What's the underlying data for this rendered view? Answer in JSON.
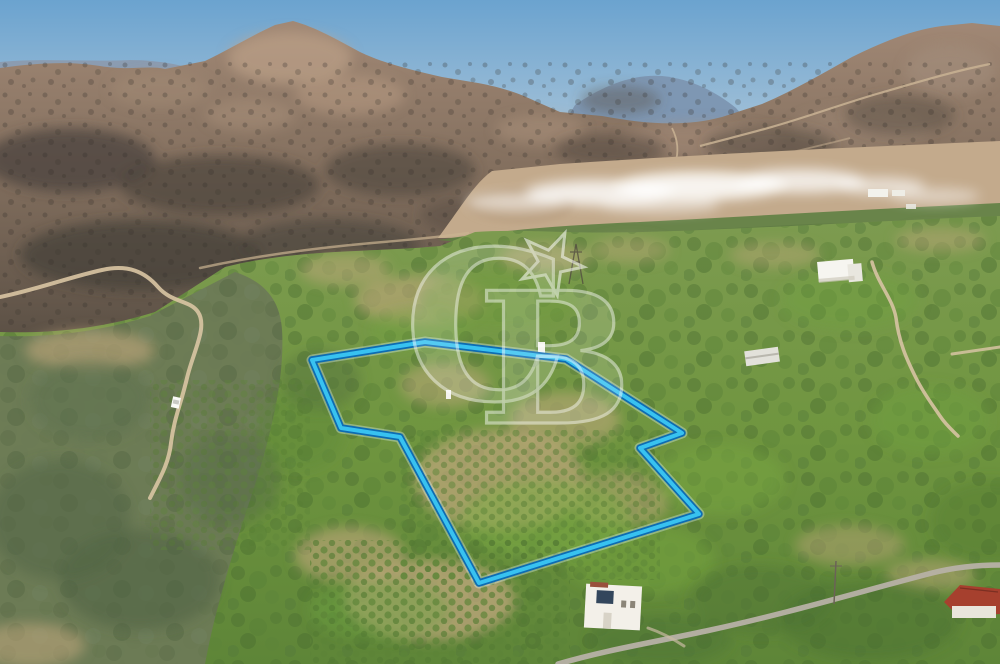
{
  "image": {
    "alt": "Aerial drone photo of a land parcel outlined in blue among green orchards, with burnt mountain slopes and a white smoke plume in the background"
  },
  "watermark": {
    "letter_c": "C",
    "letter_b": "B",
    "star_icon": "star",
    "color": "#ffffff",
    "opacity": "0.55"
  },
  "parcel": {
    "points": "312,360 425,342 566,359 682,433 640,448 699,514 479,583 400,437 341,428",
    "core_color": "#38c2f0",
    "edge_color": "#0e6cb2",
    "halo_color": "rgba(225,245,255,0.35)"
  },
  "scene": {
    "features": [
      "burnt mountain slopes",
      "smoke plume over valley",
      "olive and citrus orchards",
      "dirt roads",
      "white farmhouse",
      "storage shed",
      "two-story white house",
      "red-roofed house",
      "electricity pylon"
    ]
  },
  "palette": {
    "sky_top": "#6ba3cf",
    "sky_bottom": "#a7c3d8",
    "mountain": "#84705f",
    "burnt": "#46403a",
    "valley_soil": "#c3aa8c",
    "orchard_green": "#6f953f",
    "soil": "#c2a77d",
    "smoke": "#ffffff"
  }
}
